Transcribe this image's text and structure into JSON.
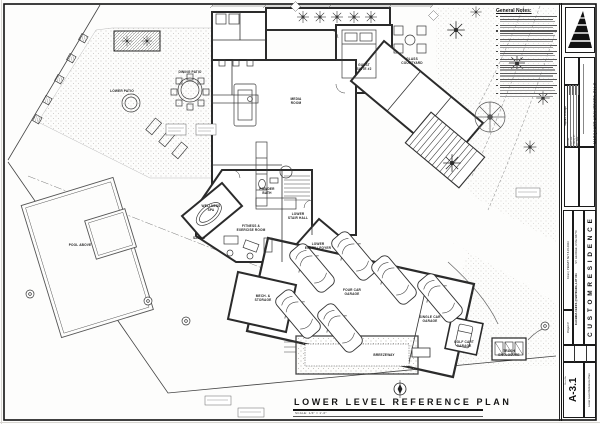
{
  "page": {
    "plan_title": "LOWER LEVEL REFERENCE PLAN",
    "plan_scale": "SCALE:  1/4\" = 1'-0\""
  },
  "general_notes": {
    "title": "General Notes:",
    "line_counts": [
      3,
      2,
      3,
      2,
      2,
      3,
      2,
      3,
      2,
      2,
      3,
      2
    ]
  },
  "title_block": {
    "firm_name": "MARQUART ARCHITECTS, PLLC",
    "logo_icon": "pyramid-logo-icon",
    "square_footage": {
      "header": "Square Footage",
      "rows": [
        "Main Level",
        "Lower Level",
        "TOTAL SQ. FT.",
        "Deck / Patio",
        "Garage / Mech."
      ]
    },
    "project_name": "C U S T O M   R E S I D E N C E",
    "address_line_1": "KACHINA CLIFFS @ ENTRADA, LOT #41",
    "address_line_2": "ST. GEORGE, UTAH 84770",
    "project_number_label": "Project #",
    "permit_text": "KCa1 | PERMIT SET 8.15.2023",
    "sheet_no_label": "Sheet No.",
    "sheet_number": "A-3.1",
    "sheet_name": "Lower Level Reference Plan"
  },
  "plan": {
    "rooms": [
      {
        "id": "dining-patio",
        "label": "DINING PATIO",
        "x": 190,
        "y": 73
      },
      {
        "id": "lower-patio",
        "label": "LOWER PATIO",
        "x": 122,
        "y": 92
      },
      {
        "id": "media-room",
        "label": "MEDIA\nROOM",
        "x": 296,
        "y": 100
      },
      {
        "id": "guest-suite",
        "label": "GUEST\nSUITE #2",
        "x": 364,
        "y": 66
      },
      {
        "id": "glass-courtyard",
        "label": "GLASS\nCOURTYARD",
        "x": 412,
        "y": 60
      },
      {
        "id": "wellness-spa",
        "label": "WELLNESS\nSPA",
        "x": 211,
        "y": 207
      },
      {
        "id": "powder-bath",
        "label": "POWDER\nBATH",
        "x": 267,
        "y": 190
      },
      {
        "id": "fitness-room",
        "label": "FITNESS &\nEXERCISE ROOM",
        "x": 251,
        "y": 227
      },
      {
        "id": "lower-stair-hall",
        "label": "LOWER\nSTAIR HALL",
        "x": 298,
        "y": 215
      },
      {
        "id": "sauna",
        "label": "SAUNA",
        "x": 199,
        "y": 239
      },
      {
        "id": "lower-entry",
        "label": "LOWER\nENTRY / FOYER",
        "x": 318,
        "y": 245
      },
      {
        "id": "mech-storage",
        "label": "MECH. &\nSTORAGE",
        "x": 263,
        "y": 297
      },
      {
        "id": "four-car-garage",
        "label": "FOUR CAR\nGARAGE",
        "x": 352,
        "y": 291
      },
      {
        "id": "single-car-garage",
        "label": "SINGLE CAR\nGARAGE",
        "x": 430,
        "y": 318
      },
      {
        "id": "golf-cart-garage",
        "label": "GOLF CART\nGARAGE",
        "x": 464,
        "y": 343
      },
      {
        "id": "trash-enclosure",
        "label": "TRASH\nENCLOSURE",
        "x": 509,
        "y": 352
      },
      {
        "id": "breezeway",
        "label": "BREEZEWAY",
        "x": 384,
        "y": 356
      },
      {
        "id": "pool-above",
        "label": "POOL ABOVE",
        "x": 80,
        "y": 246
      }
    ]
  }
}
